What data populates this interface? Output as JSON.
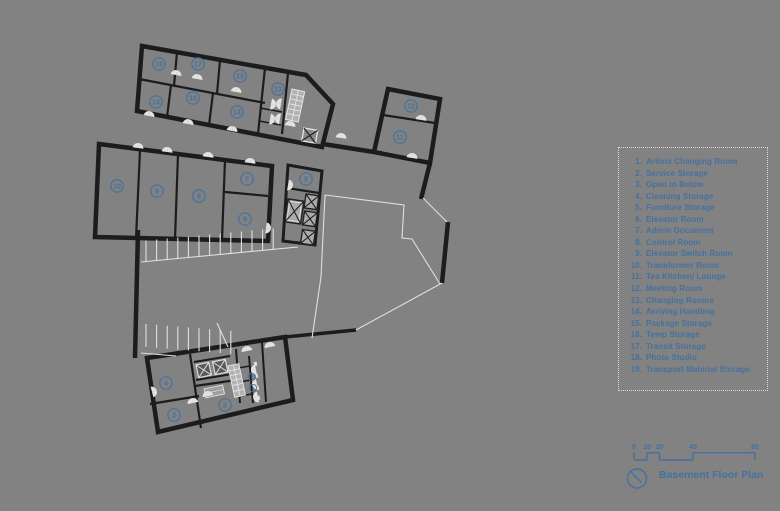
{
  "app": {
    "background": "#828282"
  },
  "palette": {
    "wall": "#1c1c1c",
    "light_line": "#e3e3e3",
    "accent_blue": "#44719f",
    "stair_fill": "#b2b2b2",
    "legend_border": "#d8d8d8"
  },
  "legend": {
    "items": [
      {
        "num": "1.",
        "label": "Artists Changing Room"
      },
      {
        "num": "2.",
        "label": "Service Storage"
      },
      {
        "num": "3.",
        "label": "Open to Below"
      },
      {
        "num": "4.",
        "label": "Cleaning Storage"
      },
      {
        "num": "5.",
        "label": "Furniture Storage"
      },
      {
        "num": "6.",
        "label": "Elevator Room"
      },
      {
        "num": "7.",
        "label": "Admin Document"
      },
      {
        "num": "8.",
        "label": "Control Room"
      },
      {
        "num": "9.",
        "label": "Elevator Switch Room"
      },
      {
        "num": "10.",
        "label": "Transformer Room"
      },
      {
        "num": "11.",
        "label": "Tea Kitchen/ Lounge"
      },
      {
        "num": "12.",
        "label": "Meeting Room"
      },
      {
        "num": "13.",
        "label": "Changing Rooms"
      },
      {
        "num": "14.",
        "label": "Arriving Handling"
      },
      {
        "num": "15.",
        "label": "Package Storage"
      },
      {
        "num": "16.",
        "label": "Temp Storage"
      },
      {
        "num": "17.",
        "label": "Transit Storage"
      },
      {
        "num": "18.",
        "label": "Photo Studio"
      },
      {
        "num": "19.",
        "label": "Transport Material Storage"
      }
    ]
  },
  "title_block": {
    "title": "Basement Floor Plan",
    "scale_ticks": [
      "0",
      "10",
      "20",
      "40",
      "80"
    ],
    "north_icon": "north-arrow"
  },
  "plan": {
    "room_labels": [
      {
        "n": "19",
        "x": 159,
        "y": 64
      },
      {
        "n": "17",
        "x": 198,
        "y": 64
      },
      {
        "n": "15",
        "x": 240,
        "y": 76
      },
      {
        "n": "18",
        "x": 156,
        "y": 102
      },
      {
        "n": "16",
        "x": 193,
        "y": 98
      },
      {
        "n": "14",
        "x": 237,
        "y": 112
      },
      {
        "n": "13",
        "x": 278,
        "y": 89
      },
      {
        "n": "12",
        "x": 411,
        "y": 106
      },
      {
        "n": "11",
        "x": 400,
        "y": 137
      },
      {
        "n": "10",
        "x": 117,
        "y": 186
      },
      {
        "n": "9",
        "x": 157,
        "y": 191
      },
      {
        "n": "8",
        "x": 199,
        "y": 196
      },
      {
        "n": "7",
        "x": 247,
        "y": 179
      },
      {
        "n": "6",
        "x": 245,
        "y": 219
      },
      {
        "n": "5",
        "x": 306,
        "y": 179
      },
      {
        "n": "4",
        "x": 166,
        "y": 383
      },
      {
        "n": "3",
        "x": 174,
        "y": 415
      },
      {
        "n": "2",
        "x": 225,
        "y": 405
      },
      {
        "n": "1",
        "x": 252,
        "y": 377,
        "small": true
      },
      {
        "n": "1",
        "x": 253,
        "y": 388,
        "small": true
      }
    ]
  }
}
